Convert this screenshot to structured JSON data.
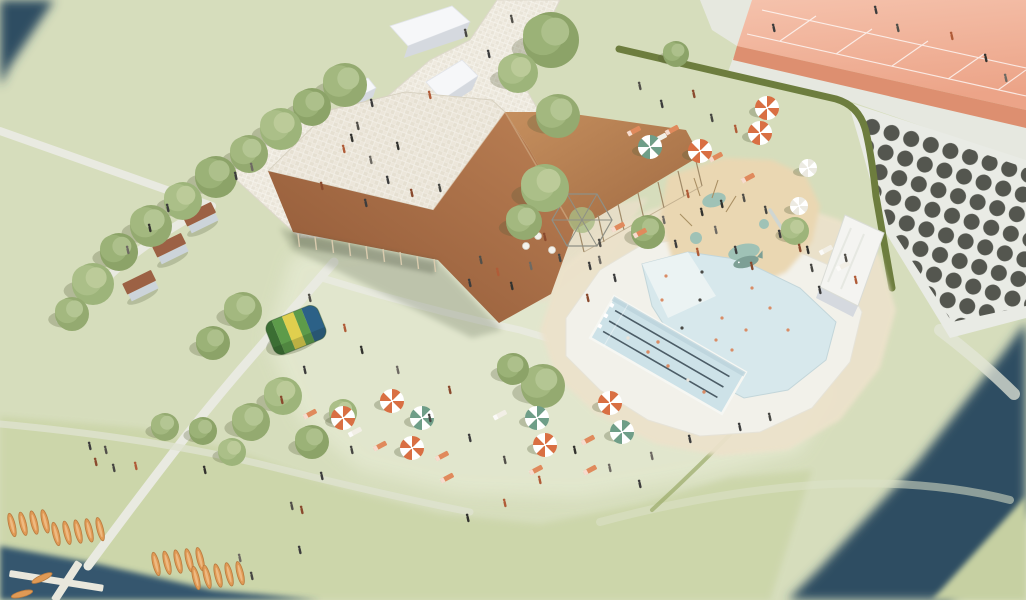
{
  "scene": {
    "type": "architectural-aerial-rendering",
    "description": "Aerial 3D rendering of a lakeside leisure park: folded-roof pavilion with rooftop terrace, lap and leisure pools, sand playground, tennis courts, sunbathing lawns with umbrellas, canoe launch dock and river",
    "palette": {
      "grass": "#d6ddbc",
      "grass_sun": "#e3e8cf",
      "grass_south": "#ccd6aa",
      "grass_far": "#c6d0a2",
      "water": "#2e4d62",
      "water_near": "#35576e",
      "path": "#e9eae1",
      "path_soft": "#e3e6d8",
      "court_front": "#dd8f70",
      "court_line": "#ffffff",
      "dot_grid": "#54564f",
      "apron": "#e9ebe5",
      "hedge": "#6d7d3e",
      "hedge_bank": "#9aa968",
      "sand": "#ece2cb",
      "sand_terrace": "#e9dfc9",
      "pool_deck": "#f2f1ea",
      "play_sand": "#ead7b2",
      "pool_water": "#cde2e8",
      "leisure_water": "#d7e8ec",
      "lane": "#3e4e58",
      "splash": "#9fc2b6",
      "whale": "#7d9f95",
      "shed": "#f6f7f9",
      "shed_shade": "#d5d9df",
      "cabin_roof": "#9c6144",
      "cabin_wall": "#ccd4da",
      "umbrella_orange": "#d96f43",
      "umbrella_green": "#6f9e88",
      "umbrella_white": "#eceae2",
      "towel_orange": "#e08a5c",
      "towel_white": "#f2efe6",
      "canoe": "#e09a55",
      "pillow_dark": "#3b6e33",
      "pillow_green": "#5d9b4a",
      "pillow_yellow": "#e0cf4e",
      "pillow_blue": "#2c6187"
    }
  },
  "objects": {
    "pool": {
      "lane_lines": 3
    },
    "trees": [
      [
        345,
        85,
        22
      ],
      [
        312,
        107,
        19
      ],
      [
        281,
        129,
        21
      ],
      [
        249,
        154,
        19
      ],
      [
        216,
        177,
        21
      ],
      [
        183,
        201,
        19
      ],
      [
        151,
        226,
        21
      ],
      [
        119,
        252,
        19
      ],
      [
        93,
        284,
        21
      ],
      [
        72,
        314,
        17
      ],
      [
        551,
        40,
        28
      ],
      [
        518,
        73,
        20
      ],
      [
        558,
        116,
        22
      ],
      [
        676,
        54,
        13
      ],
      [
        545,
        188,
        24
      ],
      [
        524,
        222,
        18
      ],
      [
        648,
        232,
        17
      ],
      [
        795,
        231,
        14
      ],
      [
        243,
        311,
        19
      ],
      [
        213,
        343,
        17
      ],
      [
        283,
        396,
        19
      ],
      [
        251,
        422,
        19
      ],
      [
        312,
        442,
        17
      ],
      [
        343,
        413,
        14
      ],
      [
        165,
        427,
        14
      ],
      [
        203,
        431,
        14
      ],
      [
        232,
        452,
        14
      ],
      [
        543,
        386,
        22
      ],
      [
        513,
        369,
        16
      ]
    ],
    "umbrellas": {
      "orange": [
        [
          767,
          108
        ],
        [
          760,
          133
        ],
        [
          700,
          151
        ],
        [
          343,
          418
        ],
        [
          392,
          401
        ],
        [
          412,
          448
        ],
        [
          545,
          445
        ],
        [
          610,
          403
        ]
      ],
      "green": [
        [
          650,
          147
        ],
        [
          422,
          418
        ],
        [
          537,
          418
        ],
        [
          622,
          432
        ]
      ],
      "white": [
        [
          808,
          168
        ],
        [
          799,
          206
        ]
      ]
    },
    "towels": [
      [
        634,
        131,
        "o"
      ],
      [
        660,
        138,
        "w"
      ],
      [
        672,
        130,
        "o"
      ],
      [
        716,
        157,
        "o"
      ],
      [
        748,
        178,
        "o"
      ],
      [
        380,
        446,
        "o"
      ],
      [
        442,
        456,
        "o"
      ],
      [
        447,
        478,
        "o"
      ],
      [
        500,
        415,
        "w"
      ],
      [
        588,
        440,
        "o"
      ],
      [
        590,
        470,
        "o"
      ],
      [
        310,
        414,
        "o"
      ],
      [
        355,
        432,
        "w"
      ],
      [
        536,
        470,
        "o"
      ],
      [
        618,
        227,
        "o"
      ],
      [
        640,
        233,
        "o"
      ],
      [
        826,
        250,
        "w"
      ],
      [
        843,
        266,
        "w"
      ]
    ],
    "canoe_groups": [
      [
        12,
        525,
        4
      ],
      [
        56,
        534,
        5
      ],
      [
        156,
        564,
        5
      ],
      [
        196,
        578,
        5
      ]
    ],
    "water_canoes": [
      [
        42,
        578,
        65
      ],
      [
        22,
        594,
        75
      ]
    ],
    "swimmers_lap": [
      [
        628,
        338
      ],
      [
        648,
        352
      ],
      [
        668,
        366
      ],
      [
        688,
        380
      ],
      [
        704,
        392
      ],
      [
        658,
        342
      ]
    ],
    "swimmers_leisure": [
      [
        700,
        300
      ],
      [
        722,
        318
      ],
      [
        746,
        330
      ],
      [
        770,
        308
      ],
      [
        682,
        328
      ],
      [
        662,
        300
      ],
      [
        732,
        350
      ],
      [
        788,
        330
      ],
      [
        702,
        272
      ],
      [
        666,
        276
      ],
      [
        752,
        288
      ],
      [
        716,
        340
      ]
    ],
    "people": [
      [
        372,
        104
      ],
      [
        358,
        127
      ],
      [
        344,
        150
      ],
      [
        398,
        147
      ],
      [
        252,
        168
      ],
      [
        236,
        177
      ],
      [
        322,
        187
      ],
      [
        466,
        34
      ],
      [
        489,
        55
      ],
      [
        512,
        20
      ],
      [
        430,
        96
      ],
      [
        352,
        139
      ],
      [
        371,
        161
      ],
      [
        388,
        181
      ],
      [
        412,
        194
      ],
      [
        440,
        189
      ],
      [
        366,
        204
      ],
      [
        481,
        261
      ],
      [
        498,
        273
      ],
      [
        512,
        287
      ],
      [
        531,
        267
      ],
      [
        470,
        284
      ],
      [
        545,
        238
      ],
      [
        560,
        259
      ],
      [
        590,
        267
      ],
      [
        600,
        244
      ],
      [
        688,
        195
      ],
      [
        702,
        213
      ],
      [
        716,
        231
      ],
      [
        736,
        251
      ],
      [
        752,
        267
      ],
      [
        766,
        211
      ],
      [
        780,
        235
      ],
      [
        744,
        199
      ],
      [
        698,
        253
      ],
      [
        722,
        205
      ],
      [
        664,
        221
      ],
      [
        676,
        245
      ],
      [
        800,
        249
      ],
      [
        812,
        269
      ],
      [
        820,
        291
      ],
      [
        846,
        259
      ],
      [
        856,
        281
      ],
      [
        808,
        251
      ],
      [
        600,
        261
      ],
      [
        615,
        279
      ],
      [
        588,
        299
      ],
      [
        770,
        418
      ],
      [
        740,
        428
      ],
      [
        310,
        299
      ],
      [
        345,
        329
      ],
      [
        362,
        351
      ],
      [
        398,
        371
      ],
      [
        305,
        371
      ],
      [
        282,
        401
      ],
      [
        430,
        419
      ],
      [
        470,
        439
      ],
      [
        505,
        461
      ],
      [
        540,
        481
      ],
      [
        575,
        451
      ],
      [
        610,
        469
      ],
      [
        640,
        485
      ],
      [
        450,
        391
      ],
      [
        352,
        451
      ],
      [
        322,
        477
      ],
      [
        292,
        507
      ],
      [
        505,
        504
      ],
      [
        468,
        519
      ],
      [
        652,
        457
      ],
      [
        690,
        440
      ],
      [
        96,
        463
      ],
      [
        114,
        469
      ],
      [
        90,
        447
      ],
      [
        106,
        451
      ],
      [
        136,
        467
      ],
      [
        205,
        471
      ],
      [
        240,
        559
      ],
      [
        300,
        551
      ],
      [
        302,
        511
      ],
      [
        252,
        577
      ],
      [
        876,
        11
      ],
      [
        898,
        29
      ],
      [
        952,
        37
      ],
      [
        986,
        59
      ],
      [
        1006,
        79
      ],
      [
        774,
        29
      ],
      [
        694,
        95
      ],
      [
        712,
        119
      ],
      [
        662,
        105
      ],
      [
        640,
        87
      ],
      [
        736,
        130
      ],
      [
        150,
        229
      ],
      [
        128,
        251
      ],
      [
        168,
        209
      ]
    ]
  }
}
